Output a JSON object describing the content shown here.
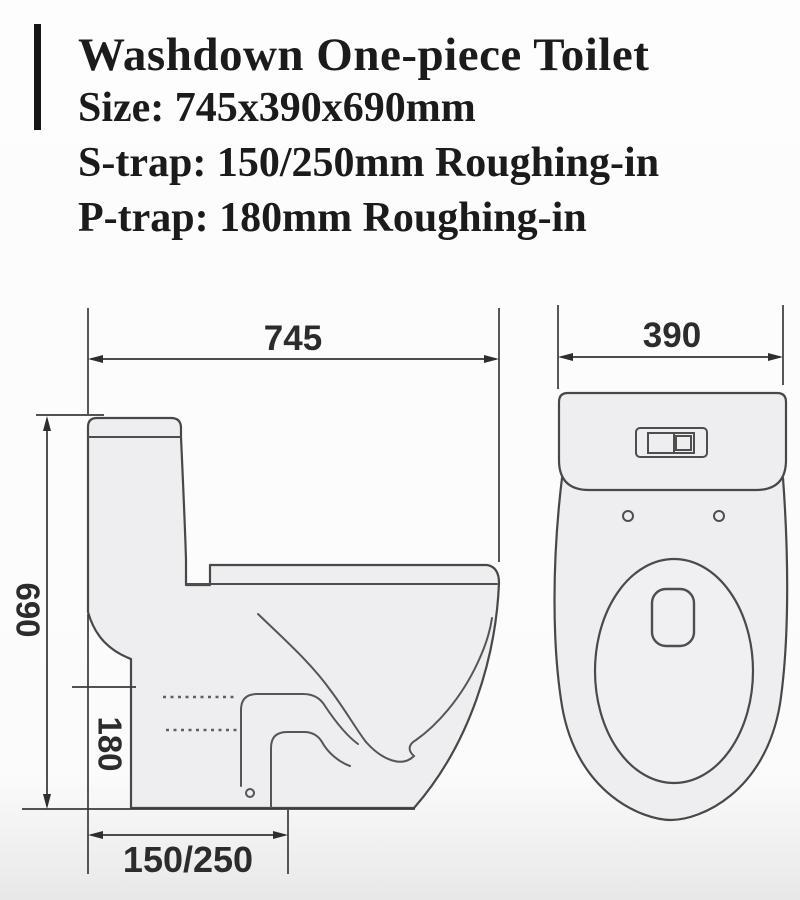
{
  "header": {
    "title": "Washdown One-piece Toilet",
    "size_line": "Size: 745x390x690mm",
    "s_trap_line": "S-trap: 150/250mm Roughing-in",
    "p_trap_line": "P-trap: 180mm Roughing-in"
  },
  "side_view": {
    "width": "745",
    "height": "690",
    "trap_height": "180",
    "roughing_in": "150/250"
  },
  "top_view": {
    "width": "390"
  },
  "colors": {
    "line": "#484848",
    "dimension_text": "#2c2c2c",
    "body_fill": "#eeeef0",
    "header_text": "#1b1b1b",
    "brand_bar": "#161616",
    "background": "#fdfdfd"
  }
}
